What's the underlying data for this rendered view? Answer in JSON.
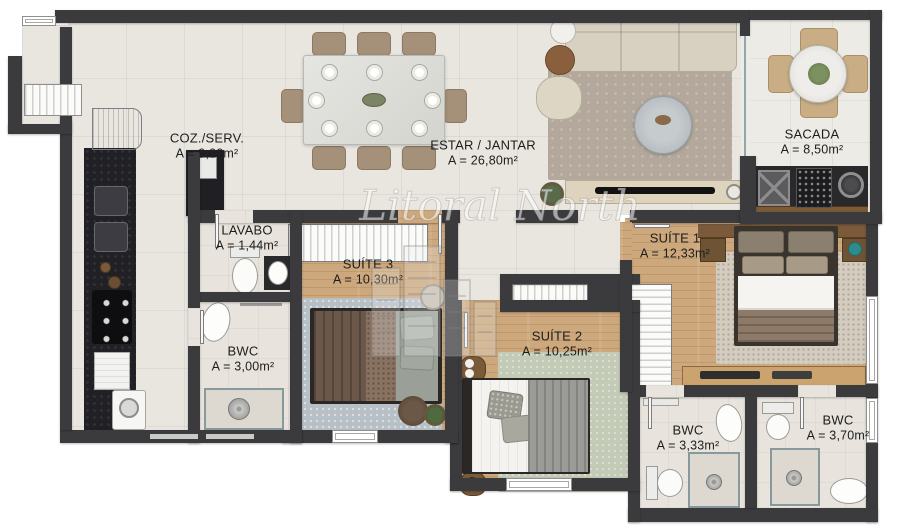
{
  "plan": {
    "watermark": "Litoral North",
    "rooms": [
      {
        "name": "COZ./SERV.",
        "area": "A = 9,00m²"
      },
      {
        "name": "ESTAR / JANTAR",
        "area": "A = 26,80m²"
      },
      {
        "name": "SACADA",
        "area": "A = 8,50m²"
      },
      {
        "name": "LAVABO",
        "area": "A = 1,44m²"
      },
      {
        "name": "SUÍTE 3",
        "area": "A = 10,30m²"
      },
      {
        "name": "SUÍTE 1",
        "area": "A = 12,33m²"
      },
      {
        "name": "SUÍTE 2",
        "area": "A = 10,25m²"
      },
      {
        "name": "BWC",
        "area": "A = 3,00m²"
      },
      {
        "name": "BWC",
        "area": "A = 3,33m²"
      },
      {
        "name": "BWC",
        "area": "A = 3,70m²"
      }
    ],
    "colors": {
      "wall": "#3b3b3e",
      "tile_floor": "#e9e6e0",
      "wood_floor": "#cda87c",
      "bath_floor": "#e8e4dd",
      "counter": "#212125",
      "label_text": "#1d1d1d"
    }
  }
}
